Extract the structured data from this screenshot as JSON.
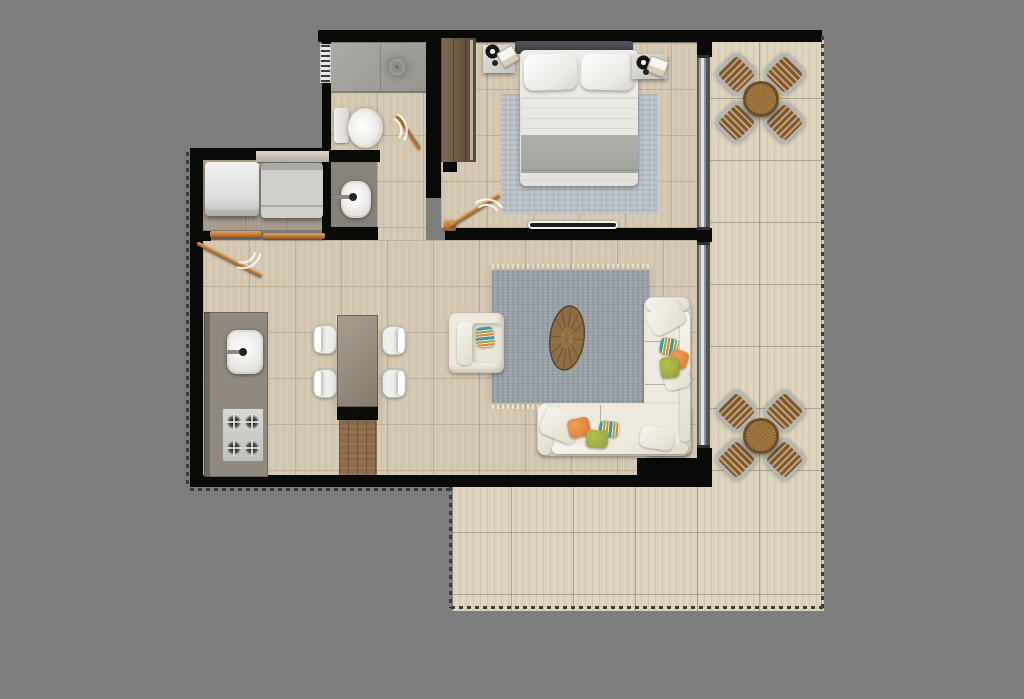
{
  "scene": {
    "type": "apartment-floor-plan",
    "view": "top-down-render",
    "units_px": {
      "width": 1024,
      "height": 699
    }
  },
  "rooms": {
    "bedroom": {
      "label": "Bedroom",
      "furniture": [
        "double bed",
        "headboard",
        "2 pillows",
        "rug",
        "left nightstand with lamp and book",
        "right nightstand with lamp and book",
        "wardrobe",
        "wall tv panel",
        "sliding glass door",
        "swing door"
      ]
    },
    "bathroom": {
      "label": "Bathroom",
      "furniture": [
        "shower with drain",
        "toilet",
        "window",
        "swing door"
      ]
    },
    "vanity": {
      "label": "Vanity",
      "furniture": [
        "washbasin with faucet"
      ]
    },
    "laundry": {
      "label": "Laundry",
      "furniture": [
        "washer",
        "dryer",
        "shelf",
        "sliding panels",
        "swing door"
      ]
    },
    "kitchen": {
      "label": "Kitchen",
      "furniture": [
        "counter",
        "sink with faucet",
        "4-burner stove"
      ]
    },
    "dining": {
      "label": "Dining",
      "furniture": [
        "rectangular table",
        "4 white chairs"
      ]
    },
    "living": {
      "label": "Living room",
      "furniture": [
        "L-shaped sectional sofa",
        "armchair",
        "oval wood coffee table",
        "gray rug with fringe",
        "6 throw pillows",
        "sliding glass door"
      ]
    },
    "entry": {
      "label": "Entry niche",
      "furniture": [
        "wood plank threshold"
      ]
    },
    "terrace": {
      "label": "Balcony / Terrace",
      "furniture": [
        "round wood bistro table with 4 slatted chairs (top)",
        "round wood bistro table with 4 slatted chairs (bottom)"
      ]
    }
  },
  "palette": {
    "bg": "#7d7d7d",
    "wall": "#0a0a09",
    "tile": "#d5c8b2",
    "terraceTile": "#ded3bd",
    "grayFloor": "#88837b",
    "laundryFloor": "#a69a8b",
    "showerFloor": "#a2a19c",
    "counter": "#8f897f",
    "woodDark": "#6f5741",
    "woodFloor": "#8b6b49",
    "door": "#c5823c",
    "linen": "#efeade",
    "rugLiving": "#9aa2a8",
    "rugBed": "#bac1c6",
    "duvet": "#a2a5a0",
    "headboard": "#47474b",
    "white": "#f4f3f0",
    "steel": "#c9c9c6",
    "accentOrange": "#e0813c",
    "accentOlive": "#9aa83e",
    "accentTeal": "#3f9aa0",
    "tableWood": "#9c7339",
    "chairSlat": "#7c5731",
    "chairFrame": "#b3b7b7",
    "diningTable": "#95887a",
    "boundary": "#3c3c3a",
    "glass": "#dfe4e5"
  }
}
